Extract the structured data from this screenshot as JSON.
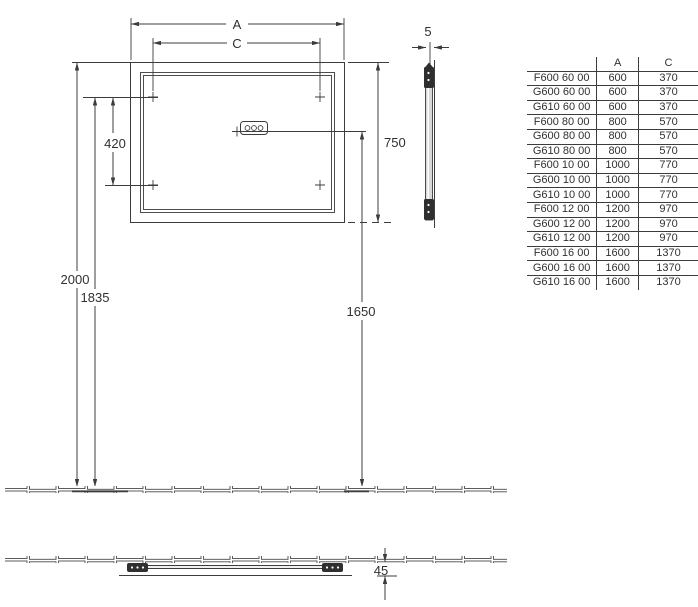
{
  "colors": {
    "line": "#3c3c3c",
    "text": "#303030",
    "glass_fill": "#d9d9d9",
    "bracket_fill": "#2f2f2f"
  },
  "front_view": {
    "width_label": "A",
    "hole_spacing_horizontal_label": "C",
    "hole_spacing_vertical": "420",
    "mirror_height": "750",
    "mirror_top_height": "2000",
    "hole_height": "1835",
    "junction_box_height": "1650"
  },
  "side_view": {
    "thickness": "5"
  },
  "plan_view": {
    "depth": "45"
  },
  "spec_table": {
    "headers": [
      "",
      "A",
      "C"
    ],
    "rows": [
      [
        "F600 60 00",
        "600",
        "370"
      ],
      [
        "G600 60 00",
        "600",
        "370"
      ],
      [
        "G610 60 00",
        "600",
        "370"
      ],
      [
        "F600 80 00",
        "800",
        "570"
      ],
      [
        "G600 80 00",
        "800",
        "570"
      ],
      [
        "G610 80 00",
        "800",
        "570"
      ],
      [
        "F600 10 00",
        "1000",
        "770"
      ],
      [
        "G600 10 00",
        "1000",
        "770"
      ],
      [
        "G610 10 00",
        "1000",
        "770"
      ],
      [
        "F600 12 00",
        "1200",
        "970"
      ],
      [
        "G600 12 00",
        "1200",
        "970"
      ],
      [
        "G610 12 00",
        "1200",
        "970"
      ],
      [
        "F600 16 00",
        "1600",
        "1370"
      ],
      [
        "G600 16 00",
        "1600",
        "1370"
      ],
      [
        "G610 16 00",
        "1600",
        "1370"
      ]
    ]
  }
}
